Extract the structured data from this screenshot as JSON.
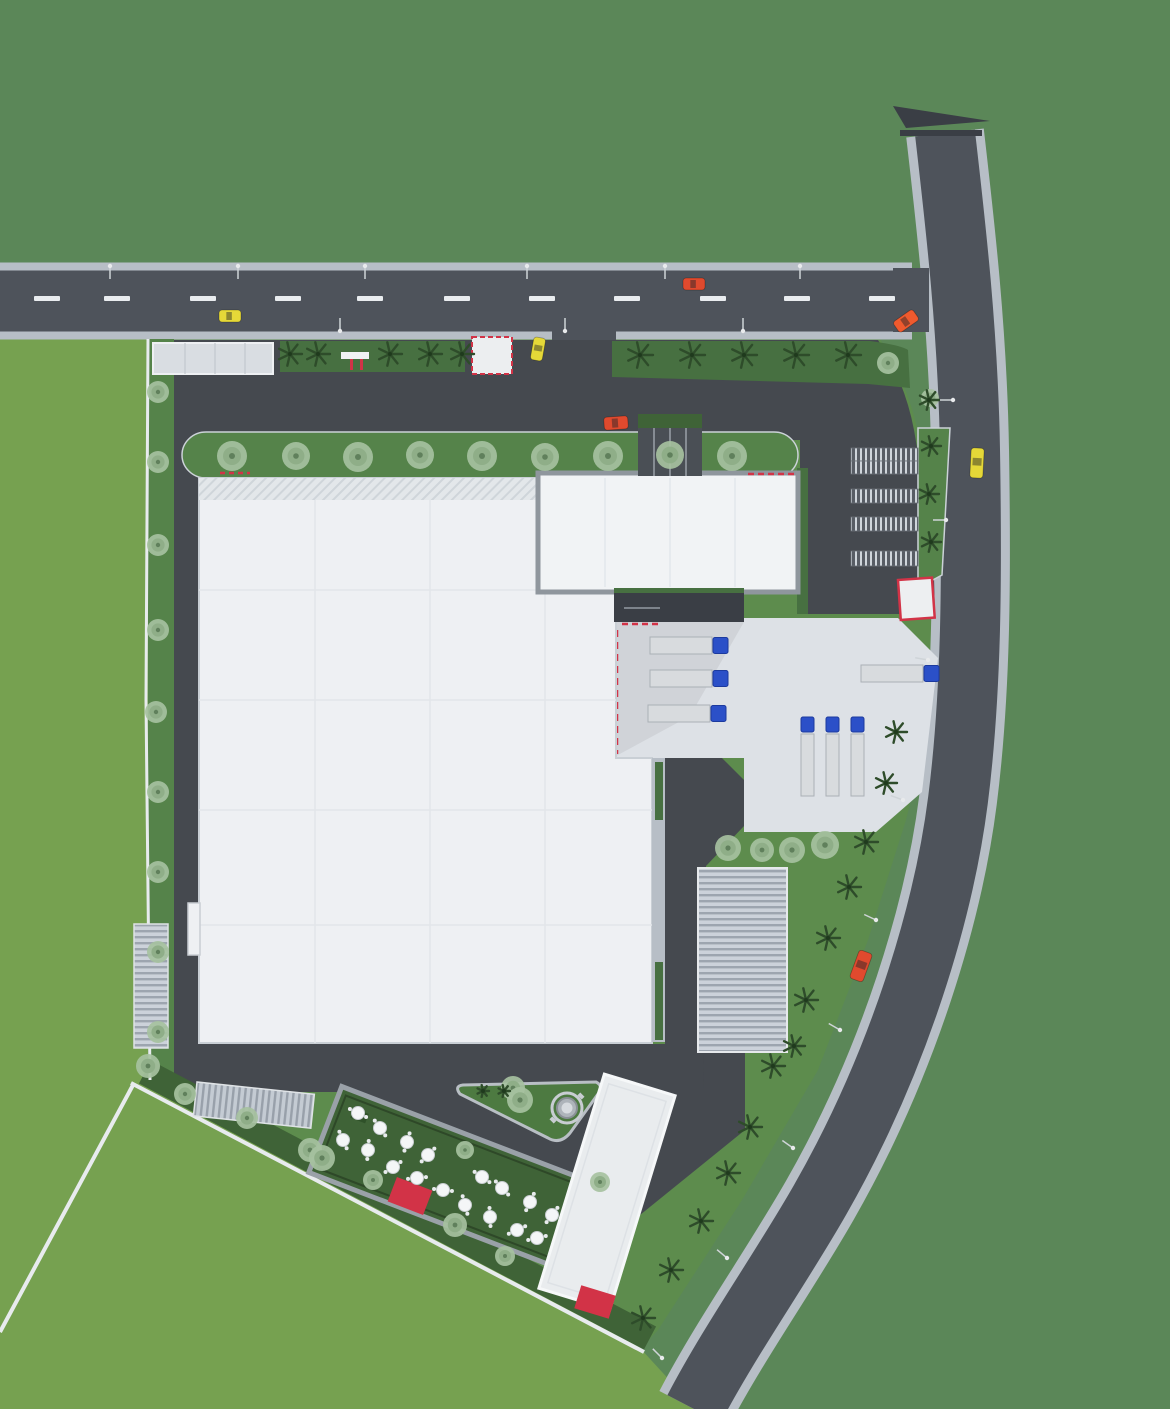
{
  "meta": {
    "title": "industrial-site-plan-top-view",
    "view": "top-down architectural 3D site plan rendering",
    "no_visible_text": true
  },
  "palette": {
    "backdrop": "#5b8758",
    "sitebase": "#5d8c4d",
    "field": "#76a150",
    "asphalt": "#4e535b",
    "innerasphalt": "#45494f",
    "sidewalk": "#b7bec6",
    "curb": "#ccd2d8",
    "pathwhite": "#e8ebee",
    "verge": "#55834a",
    "hedge": "#477041",
    "darkgreen": "#3f6337",
    "island": "#4d7a41",
    "building": "#eef0f3",
    "annex": "#f1f3f5",
    "yard": "#dde1e6",
    "canopydark": "#3a3e45",
    "red": "#d23347",
    "trailer": "#d8dbde",
    "cab": "#2b50c8",
    "sage": "#a6c1a0",
    "palm": "#2e4c2a",
    "car_yellow": "#e5d838",
    "car_red": "#e04a2e",
    "car_orange": "#ef5a2e"
  },
  "scene": {
    "summary": {
      "buildings": [
        "large-warehouse",
        "office-annex",
        "ribbed-canopy",
        "diagonal-hall",
        "entry-canopy",
        "gate-canopy"
      ],
      "parking_rows": 5,
      "docked_trucks": 3,
      "parked_vertical_trucks": 3,
      "moving_trucks": 1,
      "cars": 7,
      "patio_tables": 17,
      "fountain": 1
    },
    "road_dashes_x": [
      47,
      117,
      203,
      288,
      370,
      457,
      542,
      627,
      713,
      797,
      882
    ],
    "street_lights": [
      [
        110,
        266,
        90
      ],
      [
        238,
        266,
        90
      ],
      [
        365,
        266,
        90
      ],
      [
        527,
        266,
        90
      ],
      [
        665,
        266,
        90
      ],
      [
        800,
        266,
        90
      ],
      [
        340,
        331,
        -90
      ],
      [
        565,
        331,
        -90
      ],
      [
        743,
        331,
        -90
      ],
      [
        953,
        400,
        180
      ],
      [
        946,
        520,
        180
      ],
      [
        928,
        660,
        190
      ],
      [
        903,
        800,
        200
      ],
      [
        876,
        920,
        205
      ],
      [
        840,
        1030,
        210
      ],
      [
        793,
        1148,
        215
      ],
      [
        727,
        1258,
        220
      ],
      [
        662,
        1358,
        225
      ]
    ],
    "trees_sage": [
      [
        232,
        456,
        15
      ],
      [
        296,
        456,
        14
      ],
      [
        358,
        457,
        15
      ],
      [
        420,
        455,
        14
      ],
      [
        482,
        456,
        15
      ],
      [
        545,
        457,
        14
      ],
      [
        608,
        456,
        15
      ],
      [
        670,
        455,
        14
      ],
      [
        732,
        456,
        15
      ],
      [
        158,
        392,
        11
      ],
      [
        158,
        462,
        11
      ],
      [
        158,
        545,
        11
      ],
      [
        158,
        630,
        11
      ],
      [
        156,
        712,
        11
      ],
      [
        158,
        792,
        11
      ],
      [
        158,
        872,
        11
      ],
      [
        158,
        952,
        11
      ],
      [
        158,
        1032,
        11
      ],
      [
        148,
        1066,
        12
      ],
      [
        888,
        363,
        11
      ],
      [
        930,
        398,
        9
      ],
      [
        728,
        848,
        13
      ],
      [
        762,
        850,
        12
      ],
      [
        792,
        850,
        13
      ],
      [
        825,
        845,
        14
      ],
      [
        185,
        1094,
        11
      ],
      [
        247,
        1118,
        11
      ],
      [
        310,
        1150,
        12
      ],
      [
        322,
        1158,
        13
      ],
      [
        373,
        1180,
        10
      ],
      [
        455,
        1225,
        12
      ],
      [
        505,
        1256,
        10
      ],
      [
        513,
        1088,
        12
      ],
      [
        600,
        1182,
        10
      ],
      [
        520,
        1100,
        13
      ],
      [
        465,
        1150,
        9
      ]
    ],
    "trees_palm": [
      [
        290,
        354,
        12
      ],
      [
        318,
        354,
        12
      ],
      [
        390,
        354,
        12
      ],
      [
        430,
        354,
        12
      ],
      [
        462,
        354,
        12
      ],
      [
        640,
        355,
        13
      ],
      [
        692,
        355,
        13
      ],
      [
        744,
        355,
        13
      ],
      [
        796,
        355,
        13
      ],
      [
        848,
        355,
        13
      ],
      [
        929,
        400,
        10
      ],
      [
        931,
        446,
        10
      ],
      [
        929,
        494,
        10
      ],
      [
        931,
        542,
        10
      ],
      [
        896,
        732,
        11
      ],
      [
        886,
        783,
        11
      ],
      [
        866,
        842,
        12
      ],
      [
        849,
        887,
        12
      ],
      [
        828,
        938,
        12
      ],
      [
        806,
        1000,
        12
      ],
      [
        794,
        1046,
        11
      ],
      [
        773,
        1066,
        12
      ],
      [
        750,
        1127,
        12
      ],
      [
        728,
        1173,
        12
      ],
      [
        701,
        1221,
        12
      ],
      [
        671,
        1270,
        12
      ],
      [
        643,
        1318,
        12
      ],
      [
        483,
        1091,
        6
      ],
      [
        504,
        1091,
        6
      ]
    ],
    "patio_tables": [
      [
        358,
        1113
      ],
      [
        380,
        1128
      ],
      [
        343,
        1140
      ],
      [
        368,
        1150
      ],
      [
        407,
        1142
      ],
      [
        428,
        1155
      ],
      [
        393,
        1167
      ],
      [
        417,
        1178
      ],
      [
        443,
        1190
      ],
      [
        482,
        1177
      ],
      [
        502,
        1188
      ],
      [
        465,
        1205
      ],
      [
        490,
        1217
      ],
      [
        530,
        1202
      ],
      [
        552,
        1215
      ],
      [
        517,
        1230
      ],
      [
        537,
        1238
      ]
    ],
    "parking_rows": [
      [
        448,
        13
      ],
      [
        461,
        13
      ],
      [
        489,
        14
      ],
      [
        517,
        14
      ],
      [
        551,
        15
      ]
    ],
    "cars": [
      {
        "x": 230,
        "y": 316,
        "w": 22,
        "h": 12,
        "a": 0,
        "color": "car_yellow"
      },
      {
        "x": 694,
        "y": 284,
        "w": 22,
        "h": 12,
        "a": 0,
        "color": "car_red"
      },
      {
        "x": 906,
        "y": 321,
        "w": 24,
        "h": 13,
        "a": -35,
        "color": "car_orange"
      },
      {
        "x": 538,
        "y": 349,
        "w": 12,
        "h": 23,
        "a": 10,
        "color": "car_yellow"
      },
      {
        "x": 616,
        "y": 423,
        "w": 24,
        "h": 13,
        "a": -4,
        "color": "car_red"
      },
      {
        "x": 977,
        "y": 463,
        "w": 13,
        "h": 30,
        "a": 3,
        "color": "car_yellow"
      },
      {
        "x": 861,
        "y": 966,
        "w": 14,
        "h": 30,
        "a": 20,
        "color": "car_red"
      }
    ],
    "trucks_docked": [
      {
        "x": 650,
        "y": 637
      },
      {
        "x": 650,
        "y": 670
      },
      {
        "x": 648,
        "y": 705
      }
    ],
    "truck_moving": {
      "x": 861,
      "y": 665
    },
    "trucks_vertical_x": [
      801,
      826,
      851
    ],
    "trucks_vertical_y": 717
  }
}
